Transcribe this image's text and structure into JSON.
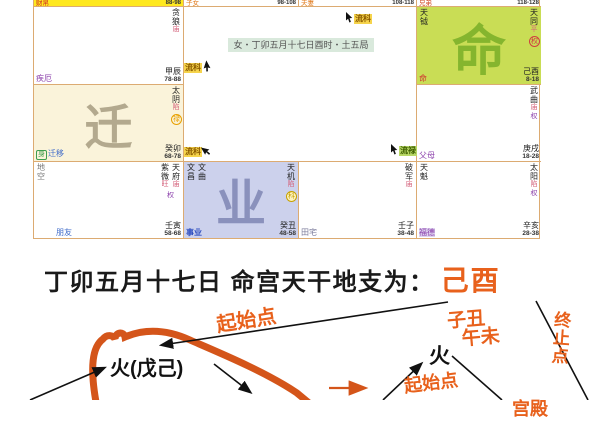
{
  "chart": {
    "info_badge": "女・丁卯五月十七日酉时・土五局",
    "slivers": [
      {
        "label": "财帛",
        "ages": "88-98"
      },
      {
        "label": "子女",
        "ages": "98-108"
      },
      {
        "label": "夫妻",
        "ages": "108-118"
      },
      {
        "label": "兄弟",
        "ages": "118-128"
      }
    ],
    "palaces": {
      "chen": {
        "label": "疾厄",
        "stem": "甲辰",
        "ages": "78-88",
        "star": "贪狼",
        "bright": "庙"
      },
      "you": {
        "label": "命",
        "stem": "己酉",
        "ages": "8-18",
        "star": "天同",
        "bright": "平",
        "hua": "权",
        "minor": "天钺",
        "watermark": "命"
      },
      "mao": {
        "label": "迁移",
        "body": "身",
        "stem": "癸卯",
        "ages": "68-78",
        "star": "太阴",
        "bright": "陷",
        "hua": "禄",
        "watermark": "迁"
      },
      "xu": {
        "label": "父母",
        "stem": "庚戌",
        "ages": "18-28",
        "star": "武曲",
        "bright": "庙",
        "selfhua": "权"
      },
      "yin": {
        "label": "朋友",
        "stem": "壬寅",
        "ages": "58-68",
        "star1": "紫微",
        "bright1": "旺",
        "star2": "天府",
        "bright2": "庙",
        "selfhua": "权",
        "minor": "地空"
      },
      "chou": {
        "label": "事业",
        "stem": "癸丑",
        "ages": "48-58",
        "star": "天机",
        "bright": "陷",
        "hua": "科",
        "minor1": "文昌",
        "minor2": "文曲",
        "watermark": "业"
      },
      "zi": {
        "label": "田宅",
        "stem": "壬子",
        "ages": "38-48",
        "star": "破军",
        "bright": "庙"
      },
      "hai": {
        "label": "福德",
        "stem": "辛亥",
        "ages": "28-38",
        "star": "太阳",
        "bright": "陷",
        "selfhua": "权",
        "minor": "天魁"
      }
    },
    "markers": {
      "m1": "流科",
      "m2": "流科",
      "m3": "流科",
      "m4": "流禄"
    }
  },
  "title": {
    "black": "丁卯五月十七日 命宫天干地支为：",
    "highlight": "己酉"
  },
  "annotation": {
    "qishidian1": "起始点",
    "huo1": "火(戊己)",
    "huo2": "火",
    "zichou": "子丑",
    "wuwei": "午未",
    "qishidian2": "起始点",
    "zhongzhidian": "终止点",
    "cutoff": "宫殿"
  },
  "colors": {
    "accent_orange": "#e8611c",
    "grid_line": "#dcab72",
    "selected_cell_yellow": "#ffe81e",
    "life_palace_green": "#c9dd55",
    "career_palace_lavender": "#ccd1ec",
    "travel_palace_cream": "#faf3da",
    "hua_lu_badge": "#e8a000",
    "hua_quan_badge": "#d04040",
    "hua_ke_badge": "#c8a200",
    "marker_yellow_bg": "#f6d44c",
    "marker_green_bg": "#b9d867"
  }
}
